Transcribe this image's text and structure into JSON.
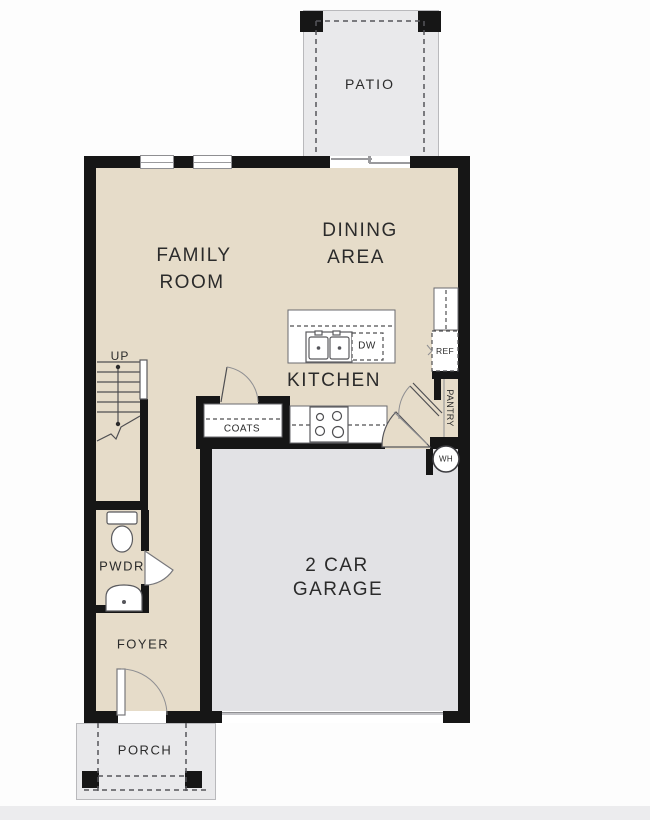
{
  "floor_plan": {
    "rooms": {
      "patio": "PATIO",
      "family_room": [
        "FAMILY",
        "ROOM"
      ],
      "dining_area": [
        "DINING",
        "AREA"
      ],
      "kitchen": "KITCHEN",
      "garage": [
        "2 CAR",
        "GARAGE"
      ],
      "foyer": "FOYER",
      "porch": "PORCH",
      "powder_room": "PWDR"
    },
    "features": {
      "stairs_direction": "UP",
      "coats_closet": "COATS",
      "dishwasher": "DW",
      "refrigerator": "REF",
      "pantry": "PANTRY",
      "water_heater": "WH"
    },
    "colors": {
      "floor_tan": "#e6dcc9",
      "garage_gray": "#e2e2e5",
      "outdoor_gray": "#e9e9eb",
      "wall_black": "#161616",
      "text_color": "#2b2b2b"
    }
  }
}
